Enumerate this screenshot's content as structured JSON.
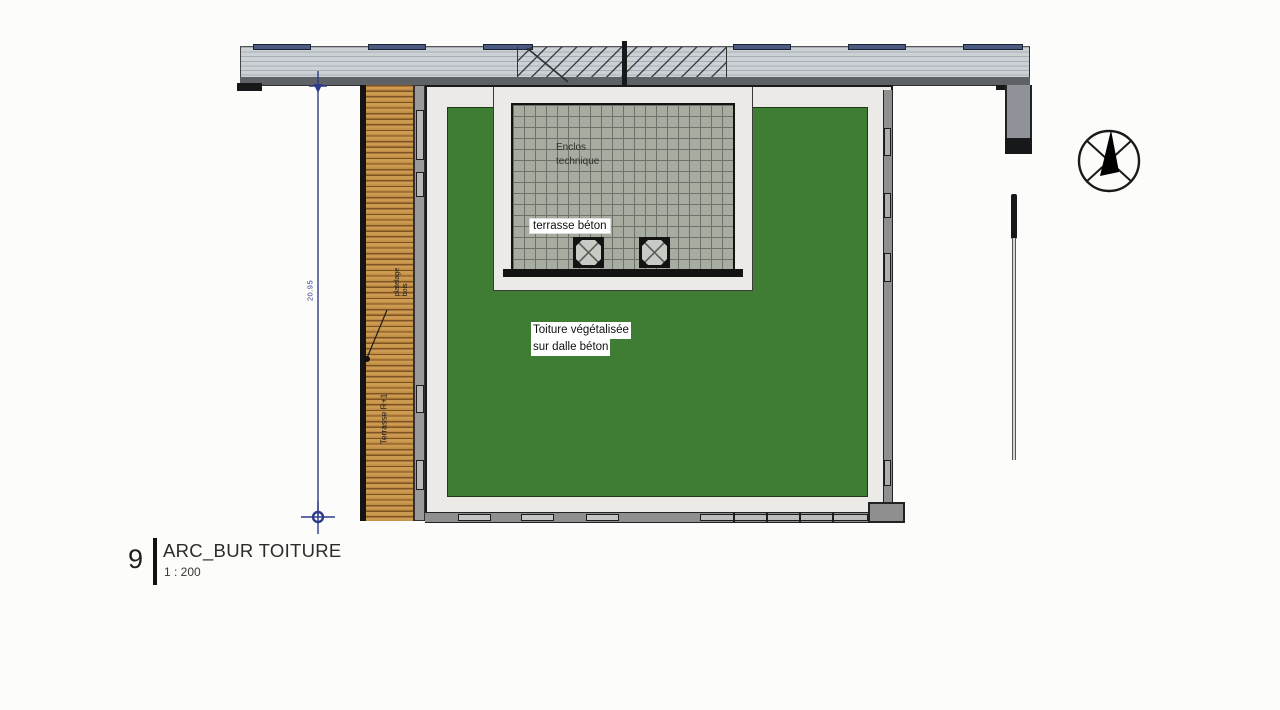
{
  "drawing": {
    "number": "9",
    "title": "ARC_BUR TOITURE",
    "scale": "1 : 200"
  },
  "annotations": {
    "enclosure_line1": "Enclos",
    "enclosure_line2": "technique",
    "concrete_terrace": "terrasse béton",
    "green_roof_line1": "Toiture végétalisée",
    "green_roof_line2": "sur dalle béton",
    "deck_label_line1": "platelage",
    "deck_label_line2": "bois",
    "terrace_level": "Terrasse R+1",
    "dimension_value": "20.95"
  },
  "icons": {
    "north_arrow": "north-arrow-compass",
    "roof_drain": "crossed-square-drain",
    "dimension_marker": "crosshair-target"
  },
  "colors": {
    "green_roof": "#3e7d33",
    "wood_deck": "#cd9a52",
    "tile_gray": "#a6ac9f",
    "roof_band_gray": "#ccd1d6",
    "dimension_blue": "#2e3b8a",
    "roof_panel_blue": "#4a5a80"
  }
}
